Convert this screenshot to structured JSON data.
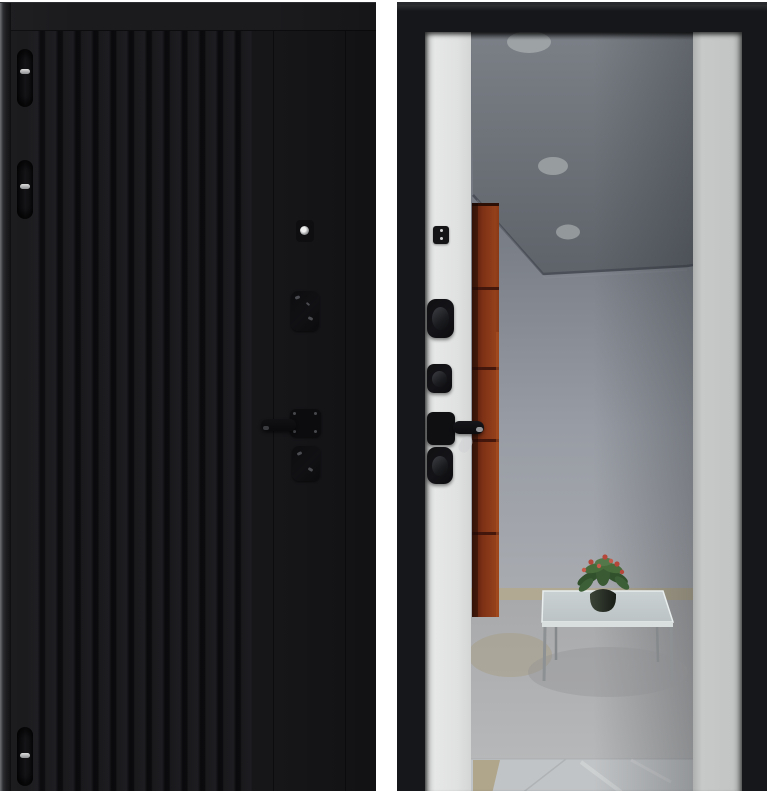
{
  "meta": {
    "description": "Product photograph of a steel entry door shown from both sides against a white background",
    "background_color": "#ffffff"
  },
  "exterior_panel": {
    "name": "Exterior door leaf: matte black with vertical milled slats",
    "finish_color": "#17171a",
    "groove_color": "#0b0b0d",
    "hinges_count": 3,
    "hardware": [
      "top-hinge",
      "middle-hinge",
      "bottom-hinge",
      "cylinder-peephole",
      "upper-lock-escutcheon",
      "door-handle",
      "lower-lock-escutcheon"
    ]
  },
  "interior_panel": {
    "name": "Interior door leaf: black frame, white side panels, full-height mirror",
    "frame_color": "#16171a",
    "left_panel_color": "#e3e4e4",
    "right_panel_color": "#c4c6c6",
    "hardware": [
      "night-latch",
      "upper-thumbturn",
      "middle-thumbturn",
      "door-handle",
      "lower-thumbturn"
    ]
  },
  "mirror_reflection": {
    "name": "Mirror reflecting a hallway interior",
    "ceiling_lights_count": 3,
    "elements": [
      "gray-ceiling",
      "recessed-round-lights",
      "orange-cabinet",
      "light-gray-wall",
      "tiled-floor",
      "glass-coffee-table",
      "potted-plant-with-red-flowers"
    ],
    "cabinet_color": "#8a3917",
    "wall_color": "#9aa0a8",
    "floor_color": "#b6b9ba",
    "table_color": "#c6cdce"
  }
}
